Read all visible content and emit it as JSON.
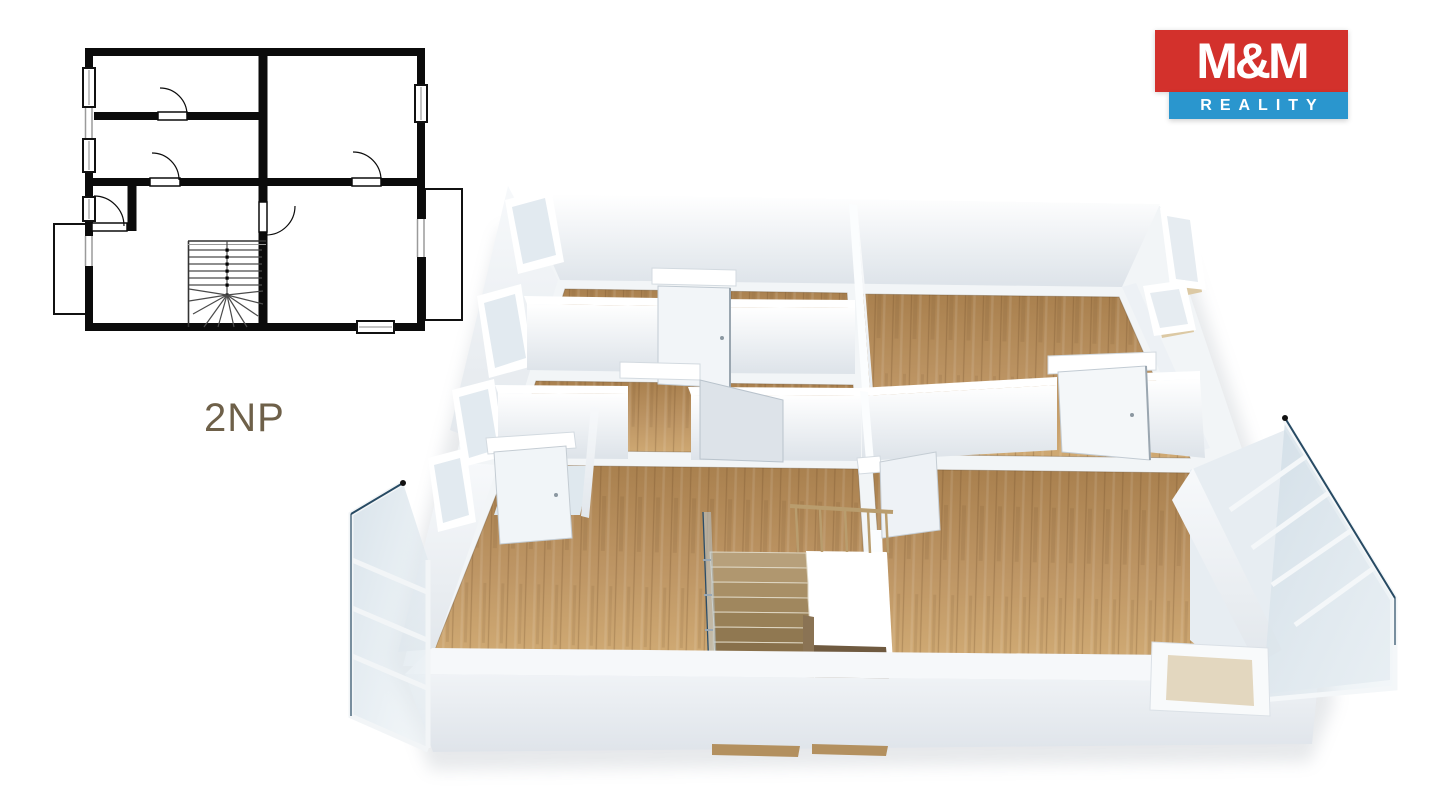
{
  "page": {
    "background_color": "#ffffff"
  },
  "plan2d": {
    "floor_label": "2NP",
    "label_color": "#6e6049",
    "wall_color": "#0b0b0b",
    "parapet_color": "#9a9a9a"
  },
  "logo": {
    "title": "M&M",
    "subtitle": "REALITY",
    "red": "#d3312c",
    "blue": "#2a96ce",
    "text_color": "#ffffff"
  },
  "plan3d": {
    "wood_color": "#b48d5e",
    "wall_color": "#eef2f5",
    "glass_edge_color": "#274a63",
    "stair_color": "#a78c64"
  }
}
